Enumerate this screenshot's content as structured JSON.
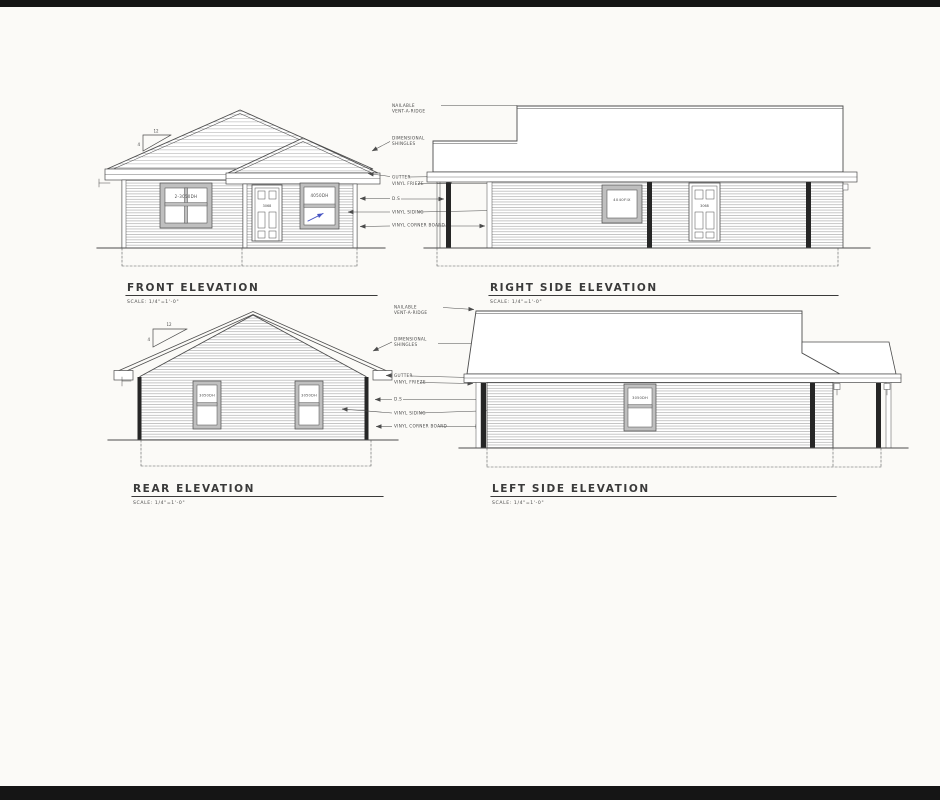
{
  "colors": {
    "paper": "#fbfaf7",
    "ink": "#4c4c4c",
    "dark_bar": "#262626",
    "frame_gray": "#bfbfbf",
    "annotation_blue": "#4553c2",
    "edge_bar": "#151515"
  },
  "callouts": {
    "nailable_line1": "NAILABLE",
    "nailable_line2": "VENT-A-RIDGE",
    "shingles_line1": "DIMENSIONAL",
    "shingles_line2": "SHINGLES",
    "gutter": "GUTTER",
    "vinyl_frieze": "VINYL FRIEZE",
    "downspout": "D.S",
    "vinyl_siding": "VINYL SIDING",
    "vinyl_corner_board": "VINYL CORNER BOARD"
  },
  "views": {
    "front": {
      "title": "FRONT ELEVATION",
      "scale": "SCALE: 1/4\"=1'-0\"",
      "window_left": "2-3050DH",
      "window_right": "4050DH",
      "door": "3068",
      "pitch_run": "12",
      "pitch_rise": "4"
    },
    "right_side": {
      "title": "RIGHT SIDE ELEVATION",
      "scale": "SCALE: 1/4\"=1'-0\"",
      "window": "4040FIX",
      "door": "3068"
    },
    "rear": {
      "title": "REAR ELEVATION",
      "scale": "SCALE: 1/4\"=1'-0\"",
      "window_left": "3050DH",
      "window_right": "3050DH",
      "pitch_run": "12",
      "pitch_rise": "4"
    },
    "left_side": {
      "title": "LEFT SIDE ELEVATION",
      "scale": "SCALE: 1/4\"=1'-0\"",
      "window": "3050DH"
    }
  }
}
